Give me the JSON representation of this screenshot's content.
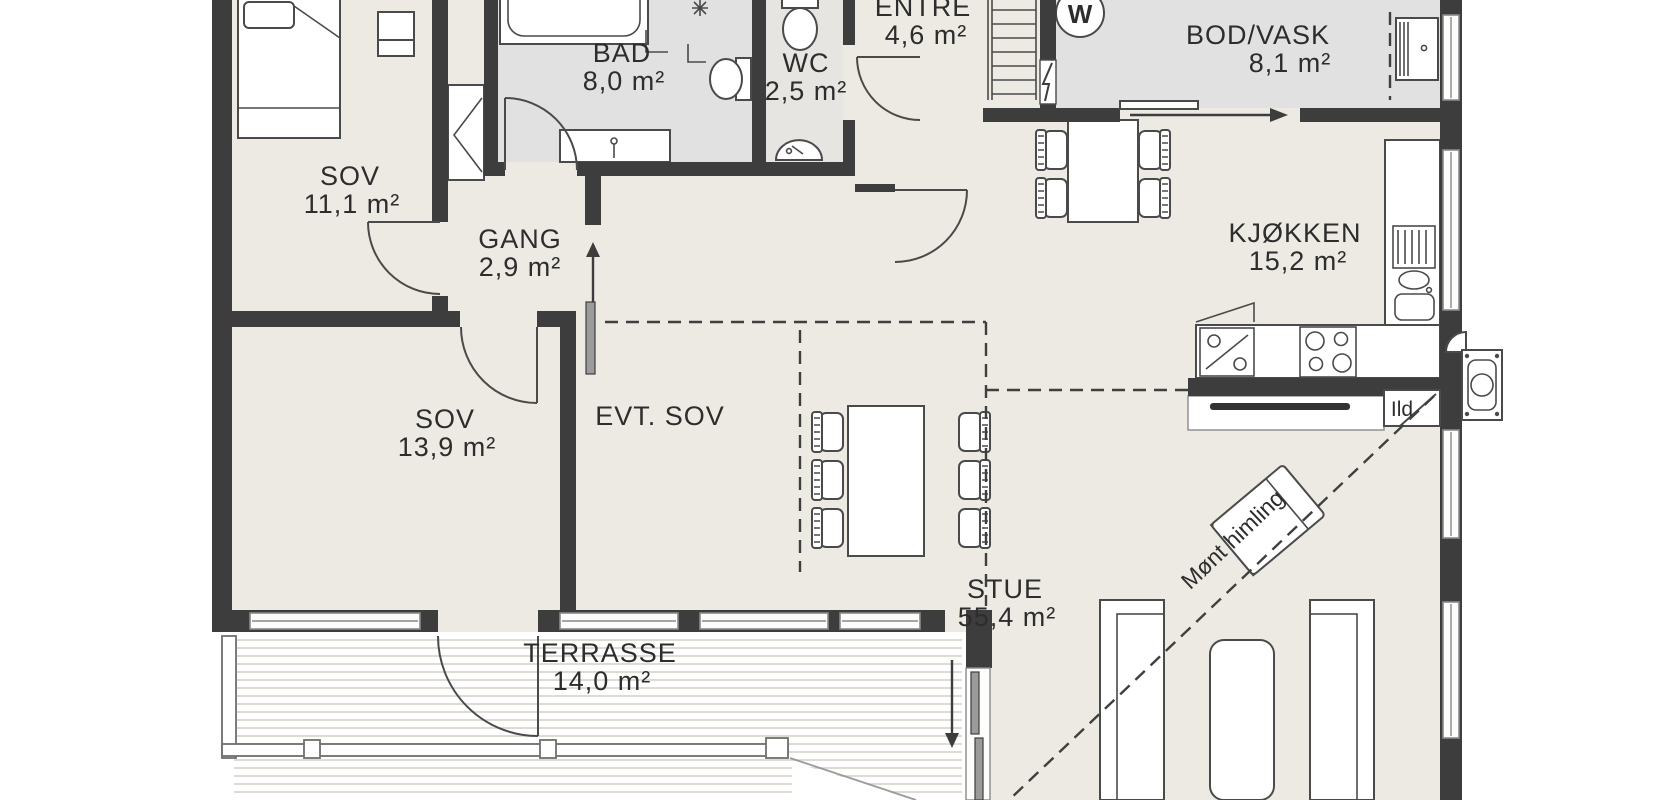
{
  "document": {
    "type": "floor-plan",
    "language": "norwegian"
  },
  "rooms": [
    {
      "name": "SOV",
      "area": "11,1 m²"
    },
    {
      "name": "BAD",
      "area": "8,0 m²"
    },
    {
      "name": "WC",
      "area": "2,5 m²"
    },
    {
      "name": "ENTRE",
      "area": "4,6 m²"
    },
    {
      "name": "BOD/VASK",
      "area": "8,1 m²"
    },
    {
      "name": "GANG",
      "area": "2,9 m²"
    },
    {
      "name": "KJØKKEN",
      "area": "15,2 m²"
    },
    {
      "name": "SOV",
      "area": "13,9 m²"
    },
    {
      "name": "EVT. SOV",
      "area": ""
    },
    {
      "name": "STUE",
      "area": "55,4 m²"
    },
    {
      "name": "TERRASSE",
      "area": "14,0 m²"
    }
  ],
  "annotations": {
    "ridge_line": "Mønt himling",
    "fireplace": "Ild",
    "washing_machine": "W"
  },
  "colors": {
    "wall": "#3d3d3d",
    "floor_main": "#edeae3",
    "floor_wet": "#e2e1e1",
    "outline": "#4a4a4a",
    "deck_stripe": "#dedbd4"
  }
}
